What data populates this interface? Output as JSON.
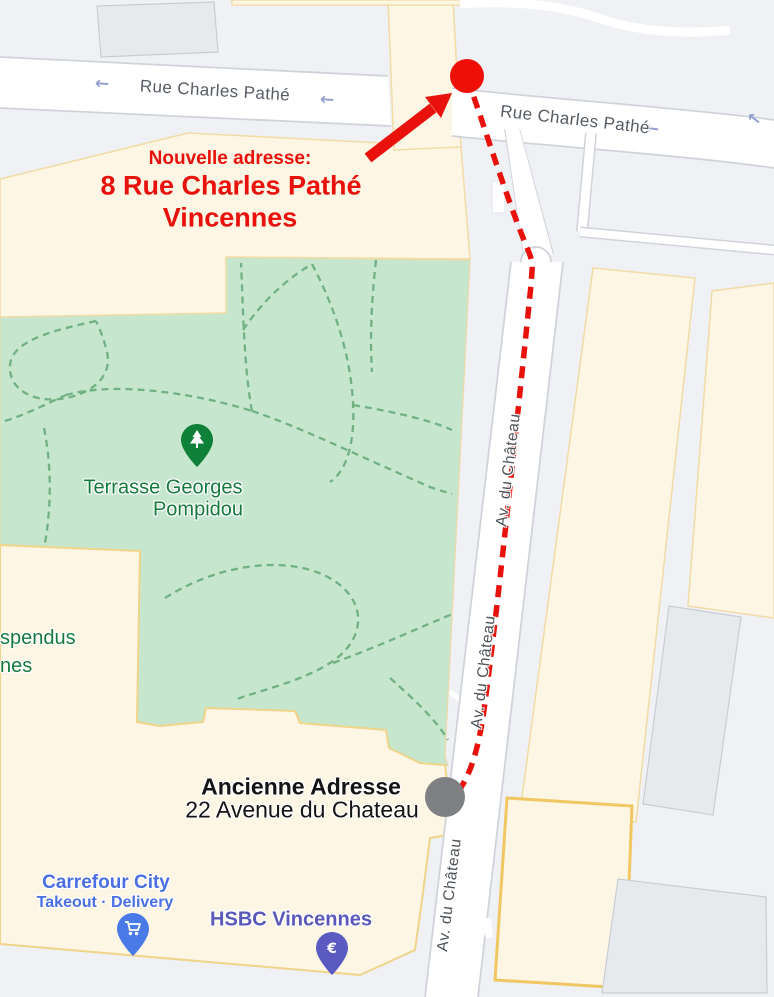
{
  "annotation": {
    "new_address": {
      "label": "Nouvelle adresse:",
      "line1": "8 Rue Charles Pathé",
      "line2": "Vincennes",
      "color": "#e8110b"
    },
    "old_address": {
      "line1": "Ancienne Adresse",
      "line2": "22 Avenue du Chateau",
      "marker_color": "#7e8084"
    }
  },
  "streets": {
    "rue_charles_pathe": "Rue Charles Pathé",
    "av_du_chateau": "Av. du Château",
    "one_way_arrow": "←"
  },
  "pois": {
    "park": {
      "line1": "Terrasse Georges",
      "line2": "Pompidou",
      "color": "#167a3d"
    },
    "partial_left": {
      "line1": "spendus",
      "line2": "nes"
    },
    "carrefour": {
      "name": "Carrefour City",
      "subtitle": "Takeout · Delivery",
      "color": "#4a6fe3"
    },
    "hsbc": {
      "name": "HSBC Vincennes",
      "euro_glyph": "€",
      "color": "#5a58b9"
    }
  },
  "map_colors": {
    "background": "#eff1f4",
    "road": "#ffffff",
    "building": "#fdf6e5",
    "building_border": "#f2dca6",
    "park": "#c6e6ce",
    "park_path": "#72b182",
    "route_red": "#e8110b",
    "marker_gray": "#7e8084"
  }
}
